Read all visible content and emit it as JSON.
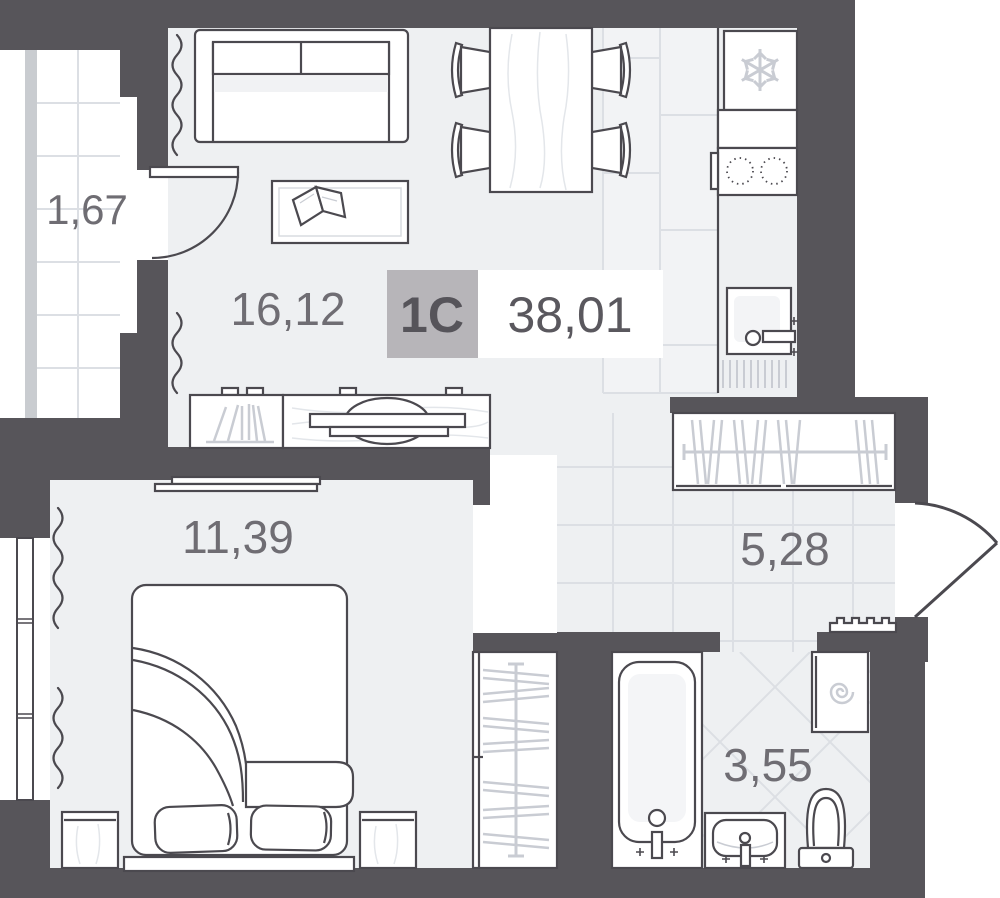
{
  "plan": {
    "badge": {
      "type": "1С",
      "area": "38,01"
    },
    "rooms": [
      {
        "id": "balcony",
        "area": "1,67"
      },
      {
        "id": "living-kitchen",
        "area": "16,12"
      },
      {
        "id": "bedroom",
        "area": "11,39"
      },
      {
        "id": "hallway",
        "area": "5,28"
      },
      {
        "id": "bathroom",
        "area": "3,55"
      }
    ],
    "icons": {
      "fridge": "snowflake-icon",
      "washing_machine": "spiral-icon",
      "electric_panel": "comb-icon"
    },
    "colors": {
      "wall": "#57555a",
      "floor": "#eef0f2",
      "kitchen_tile": "#f2f3f5",
      "tile_grid": "#dcdfe4",
      "light_detail": "#c9ccd3",
      "outline": "#4b494f",
      "label": "#6f6d73",
      "badge_bg": "#b7b5b9",
      "balcony_edge": "#c9ccd0"
    }
  }
}
